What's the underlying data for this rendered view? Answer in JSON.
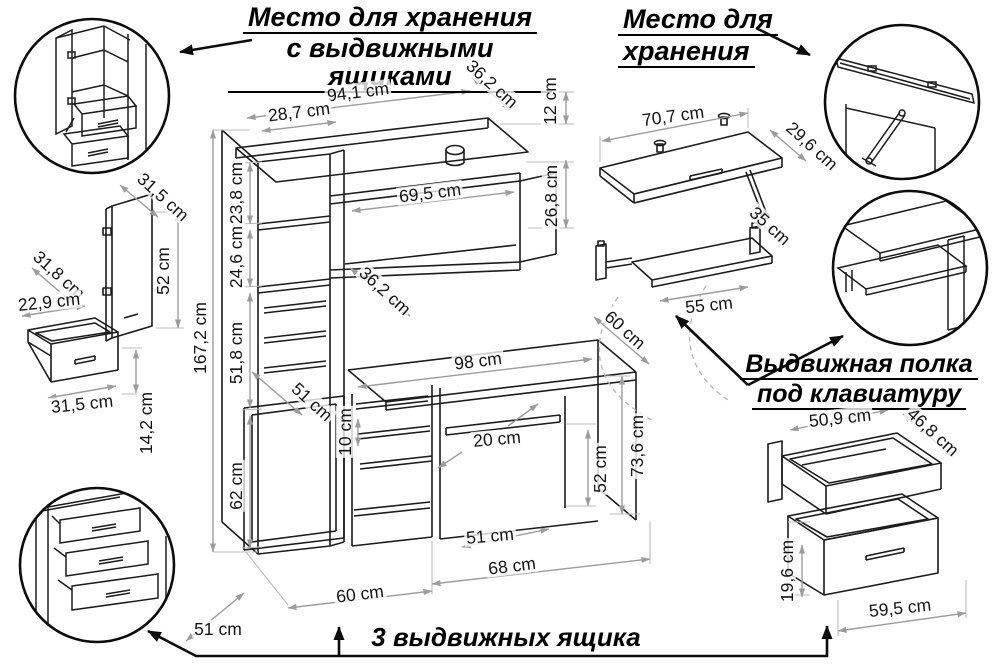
{
  "titles": {
    "storage_with_drawers": {
      "line1": "Место для хранения",
      "line2": "с выдвижными ящиками"
    },
    "storage": {
      "line1": "Место для",
      "line2": "хранения"
    },
    "keyboard_shelf_label": {
      "line1": "Выдвижная полка",
      "line2": "под клавиатуру"
    },
    "three_drawers": "3 выдвижных ящика"
  },
  "dimensions": {
    "main_unit": {
      "top_width": "94,1 cm",
      "top_depth": "36,2 cm",
      "top_gap_height": "12 cm",
      "tower_width": "28,7 cm",
      "niche_width": "69,5 cm",
      "niche_height": "26,8 cm",
      "upper_section_height": "23,8 cm",
      "middle_section_height": "24,6 cm",
      "drawer_section_depth": "36,2 cm",
      "total_height": "167,2 cm",
      "desk_to_niche_height": "51,8 cm",
      "hutch_lower_depth": "51 cm",
      "desktop_width": "98 cm",
      "desktop_depth": "60 cm",
      "shelf_depth": "20 cm",
      "drawer_spacing": "10 cm",
      "cabinet_height": "62 cm",
      "knee_space_height": "52 cm",
      "desk_height": "73,6 cm",
      "knee_space_depth": "51 cm",
      "knee_space_width": "68 cm",
      "cabinet_width": "60 cm",
      "floor_depth": "51 cm"
    },
    "door_panel": {
      "width": "31,5 cm",
      "height": "52 cm"
    },
    "small_drawer": {
      "depth": "31,8 cm",
      "inner_width": "22,9 cm",
      "front_width": "31,5 cm",
      "front_height": "14,2 cm"
    },
    "wall_shelf": {
      "width": "70,7 cm",
      "depth": "29,6 cm"
    },
    "keyboard_shelf": {
      "depth": "35 cm",
      "width": "55 cm"
    },
    "large_drawer": {
      "inner_width": "50,9 cm",
      "depth": "46,8 cm",
      "front_height": "19,6 cm",
      "front_width": "59,5 cm"
    }
  },
  "colors": {
    "line": "#1c1c1c",
    "dimension": "#9c9c9c",
    "background": "#ffffff",
    "text": "#141414"
  }
}
